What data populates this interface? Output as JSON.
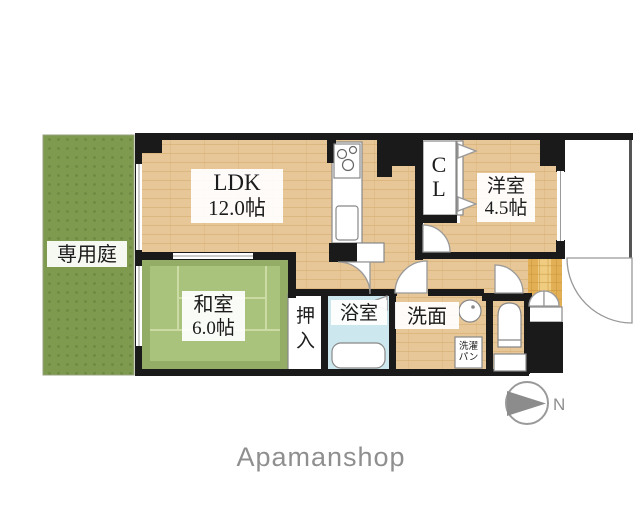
{
  "branding": {
    "logo_text": "Apamanshop"
  },
  "compass": {
    "north_label": "N"
  },
  "colors": {
    "wall": "#1a1a1a",
    "wood": "#e7c697",
    "wood_line": "#d8b176",
    "tatami_border": "#93ad67",
    "tatami": "#aac37c",
    "tatami_seam": "#ccdaa4",
    "garden": "#7d9a4e",
    "garden_dot": "#6d8840",
    "bath_floor": "#cde7ee",
    "tile": "#f0cc80",
    "tile_side": "#e3af55",
    "tile_line": "#c4933b",
    "logo_gray": "#8f8f8f"
  },
  "rooms": {
    "garden": {
      "label": "専用庭"
    },
    "ldk": {
      "name": "LDK",
      "size": "12.0帖"
    },
    "western_room": {
      "name": "洋室",
      "size": "4.5帖"
    },
    "japanese_room": {
      "name": "和室",
      "size": "6.0帖"
    },
    "closet": {
      "label": "CL",
      "chars": [
        "C",
        "L"
      ]
    },
    "oshiire": {
      "label": "押入",
      "chars": [
        "押",
        "入"
      ]
    },
    "bathroom": {
      "label": "浴室"
    },
    "washroom": {
      "label": "洗面"
    },
    "laundry_pan": {
      "label": "洗濯パン",
      "lines": [
        "洗濯",
        "パン"
      ]
    }
  }
}
